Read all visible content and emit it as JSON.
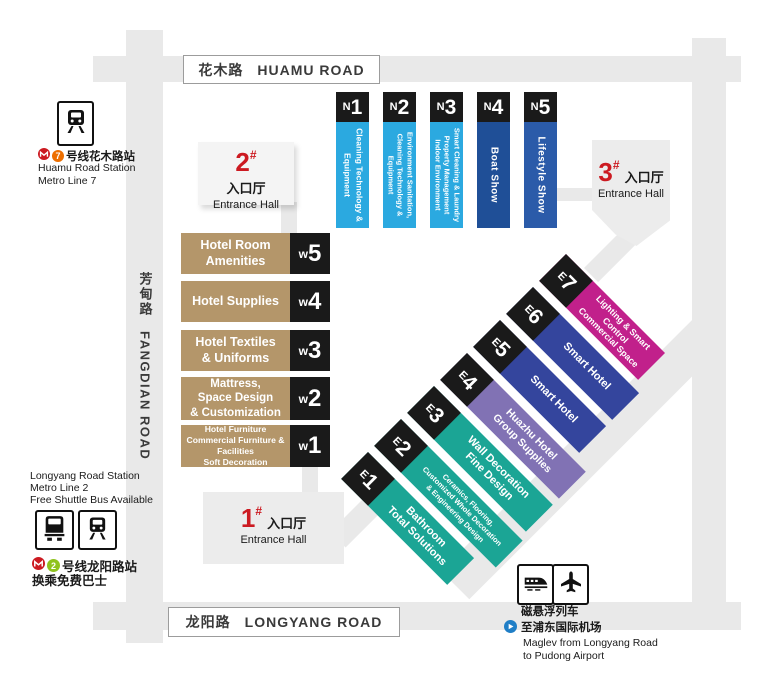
{
  "colors": {
    "road": "#e9e9e9",
    "entrance_box": "#ececec",
    "badge_black": "#1a1a1a",
    "accent_red": "#cc1a21",
    "metro_line7": "#ed6f00",
    "metro_line2": "#8fc31f",
    "maglev_blue": "#1f7ec6",
    "light_blue": "#2ba9e0",
    "dark_blue": "#1f4f97",
    "mid_blue": "#2b5ba9",
    "khaki": "#b4966a",
    "teal": "#1ba595",
    "purple": "#8172b4",
    "indigo": "#34459d",
    "magenta": "#c1208b"
  },
  "roads": {
    "huamu": {
      "zh": "花木路",
      "en": "HUAMU ROAD"
    },
    "fangdian": {
      "zh": "芳甸路",
      "en": "FANGDIAN ROAD"
    },
    "longyang": {
      "zh": "龙阳路",
      "en": "LONGYANG ROAD"
    }
  },
  "entrances": [
    {
      "num": "1",
      "hash": "#",
      "zh": "入口厅",
      "en": "Entrance Hall"
    },
    {
      "num": "2",
      "hash": "#",
      "zh": "入口厅",
      "en": "Entrance Hall"
    },
    {
      "num": "3",
      "hash": "#",
      "zh": "入口厅",
      "en": "Entrance Hall"
    }
  ],
  "halls": {
    "north": [
      {
        "prefix": "N",
        "num": "1",
        "label": "Cleaning Technology &\nEquipment",
        "color": "#2ba9e0"
      },
      {
        "prefix": "N",
        "num": "2",
        "label": "Environment Sanitation,\nCleaning Technology &\nEquipment",
        "color": "#2ba9e0"
      },
      {
        "prefix": "N",
        "num": "3",
        "label": "Smart Cleaning & Laundry\nProperty Management\nIndoor Environment",
        "color": "#2ba9e0"
      },
      {
        "prefix": "N",
        "num": "4",
        "label": "Boat Show",
        "color": "#1f4f97"
      },
      {
        "prefix": "N",
        "num": "5",
        "label": "Lifestyle Show",
        "color": "#2b5ba9"
      }
    ],
    "west": [
      {
        "prefix": "w",
        "num": "5",
        "label": "Hotel Room\nAmenities",
        "color": "#b4966a"
      },
      {
        "prefix": "w",
        "num": "4",
        "label": "Hotel Supplies",
        "color": "#b4966a"
      },
      {
        "prefix": "w",
        "num": "3",
        "label": "Hotel Textiles\n& Uniforms",
        "color": "#b4966a"
      },
      {
        "prefix": "w",
        "num": "2",
        "label": "Mattress,\nSpace Design\n& Customization",
        "color": "#b4966a"
      },
      {
        "prefix": "w",
        "num": "1",
        "label": "Hotel Furniture\nCommercial Furniture & Facilities\nSoft Decoration",
        "color": "#b4966a"
      }
    ],
    "east": [
      {
        "prefix": "E",
        "num": "1",
        "label": "Bathroom\nTotal Solutions",
        "color": "#1ba595"
      },
      {
        "prefix": "E",
        "num": "2",
        "label": "Ceramics, Flooring,\nCustomized Whole Decoration\n& Engineering Design",
        "color": "#1ba595"
      },
      {
        "prefix": "E",
        "num": "3",
        "label": "Wall Decoration\nFine Design",
        "color": "#1ba595"
      },
      {
        "prefix": "E",
        "num": "4",
        "label": "Huazhu Hotel\nGroup Supplies",
        "color": "#8172b4"
      },
      {
        "prefix": "E",
        "num": "5",
        "label": "Smart Hotel",
        "color": "#34459d"
      },
      {
        "prefix": "E",
        "num": "6",
        "label": "Smart Hotel",
        "color": "#34459d"
      },
      {
        "prefix": "E",
        "num": "7",
        "label": "Lighting & Smart Control\nCommercial Space",
        "color": "#c1208b"
      }
    ]
  },
  "stations": {
    "huamu": {
      "line_num": "7",
      "zh": "号线花木路站",
      "en_line1": "Huamu Road Station",
      "en_line2": "Metro Line 7"
    },
    "longyang": {
      "en_line1": "Longyang Road Station",
      "en_line2": "Metro Line 2",
      "en_line3": "Free Shuttle Bus Available",
      "line_num": "2",
      "zh_line1": "号线龙阳路站",
      "zh_line2": "换乘免费巴士"
    }
  },
  "maglev": {
    "zh_line1": "磁悬浮列车",
    "zh_line2": "至浦东国际机场",
    "en_line1": "Maglev from Longyang Road",
    "en_line2": "to Pudong Airport"
  },
  "icons": {
    "metro_logo": "shanghai-metro-logo",
    "train": "train-icon",
    "bus": "bus-icon",
    "maglev_train": "maglev-train-icon",
    "plane": "plane-icon",
    "direction": "play-direction-icon"
  }
}
